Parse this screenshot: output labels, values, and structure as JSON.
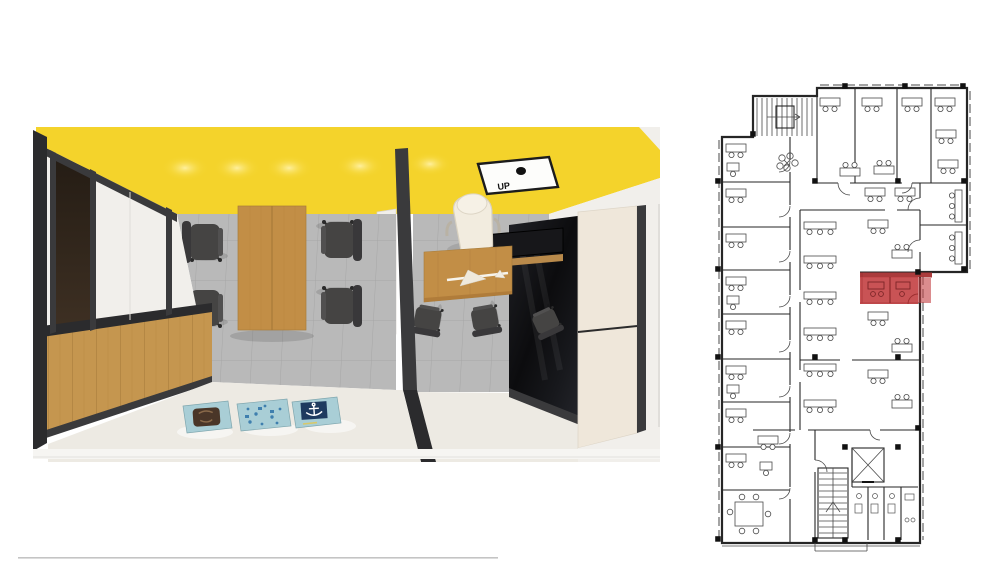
{
  "page": {
    "background": "#ffffff",
    "bottom_rule_color": "#c4c4c4"
  },
  "colors": {
    "ceiling_yellow": "#f4d32b",
    "glow": "#fff1a3",
    "frame_dark": "#3a3a3c",
    "frame_darker": "#2b2b2d",
    "wood": "#c5964f",
    "wood_table": "#c28e46",
    "wood_shelf": "#b98a4b",
    "floor_tile": "#b9b9b9",
    "tile_line": "#a6a6a6",
    "floor_cream": "#edeae3",
    "wall_white": "#f1efeb",
    "cabinet_cream": "#efe7da",
    "glass_black": "#141416",
    "chair_dark": "#454443",
    "chair_back": "#39383a",
    "chair_white": "#f2ecdf",
    "door_brown": "#2f2419",
    "art_teal": "#a9ced6",
    "art_navy": "#1e3a5f",
    "art_brown": "#4a3628",
    "art_blue": "#3f7fae",
    "plan_wall": "#262626",
    "plan_line": "#4a4a4a",
    "plan_red": "#c34042",
    "plan_red_dark": "#a63032"
  },
  "render": {
    "ceiling_sign_label": "UP"
  }
}
